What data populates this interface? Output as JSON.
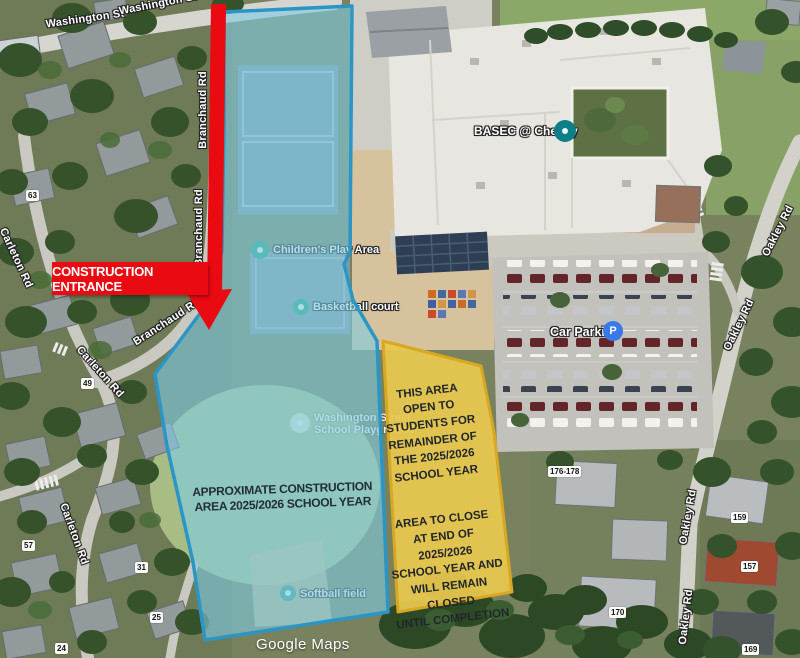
{
  "annotations": {
    "entrance_label": "CONSTRUCTION ENTRANCE",
    "construction_area_label": "APPROXIMATE CONSTRUCTION\nAREA 2025/2026 SCHOOL YEAR",
    "open_area_paragraph1": "THIS AREA\nOPEN TO\nSTUDENTS FOR\nREMAINDER OF\nTHE 2025/2026\nSCHOOL YEAR",
    "open_area_paragraph2": "AREA TO CLOSE\nAT END OF\n2025/2026\nSCHOOL YEAR AND\nWILL REMAIN\nCLOSED\nUNTIL COMPLETION",
    "colors": {
      "construction_overlay": "#7ecbe2",
      "construction_border": "#2b96c6",
      "open_overlay": "#e9c84e",
      "open_border": "#d8a820",
      "arrow_red": "#e90a12"
    }
  },
  "map": {
    "attribution": "Google Maps",
    "roads": {
      "washington": "Washington St",
      "branchaud": "Branchaud Rd",
      "carleton": "Carleton Rd",
      "oakley": "Oakley Rd"
    },
    "pois": {
      "children_play": "Children's Play Area",
      "basketball": "Basketball court",
      "playground_line1": "Washington Street",
      "playground_line2": "School Playground",
      "softball": "Softball field",
      "basec": "BASEC @ Cheney",
      "car_parking": "Car Parking",
      "parking_icon": "P",
      "parking_icon_color": "#3a79e8"
    },
    "house_numbers": [
      "63",
      "49",
      "57",
      "31",
      "25",
      "24",
      "176-178",
      "159",
      "157",
      "170",
      "169"
    ]
  }
}
